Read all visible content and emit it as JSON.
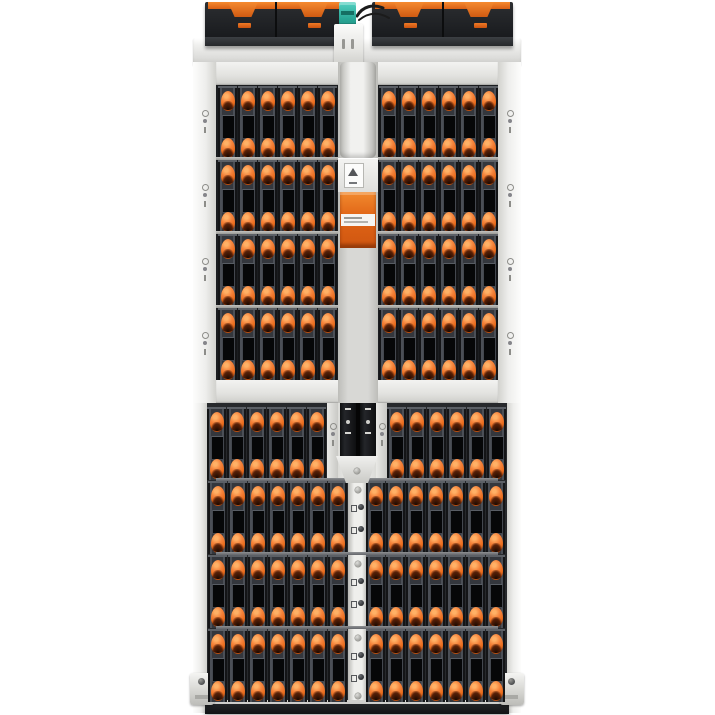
{
  "image": {
    "type": "product-photo",
    "subject": "high-density top-loading storage enclosure (JBOD disk array), top view",
    "background": "#ffffff"
  },
  "palette": {
    "latch_orange": "#e96c1d",
    "accent_orange_bright": "#f58a30",
    "accent_orange_dark": "#cf5610",
    "teal_connector": "#2aa796",
    "chassis_silver": "#e6e6e3",
    "rail_white": "#f4f4f2",
    "drive_body_gray": "#34373d",
    "drive_window_black": "#060708",
    "module_black": "#1e2023",
    "bottom_bar_black": "#17181a"
  },
  "enclosure": {
    "fan_modules_top": 4,
    "sas_connectors": 1,
    "upper_half": {
      "rows": 4,
      "drives_per_side": 6
    },
    "lower_half": {
      "rows": 4,
      "drives_per_side_by_row": [
        6,
        7,
        7,
        7
      ]
    },
    "latches_per_tray": 2,
    "visible_trays_total": 102,
    "orange_cable_tabs_per_arm": 3
  },
  "icons": {
    "row_indicator": "drive-row-indicator-icon (circle, dot, bar glyphs on rails)",
    "warning_label": "caution-triangle-icon on center label module",
    "strip_indicator": "port-indicator-icon pairs on lower center strip",
    "screw": "screw-head-icon"
  }
}
